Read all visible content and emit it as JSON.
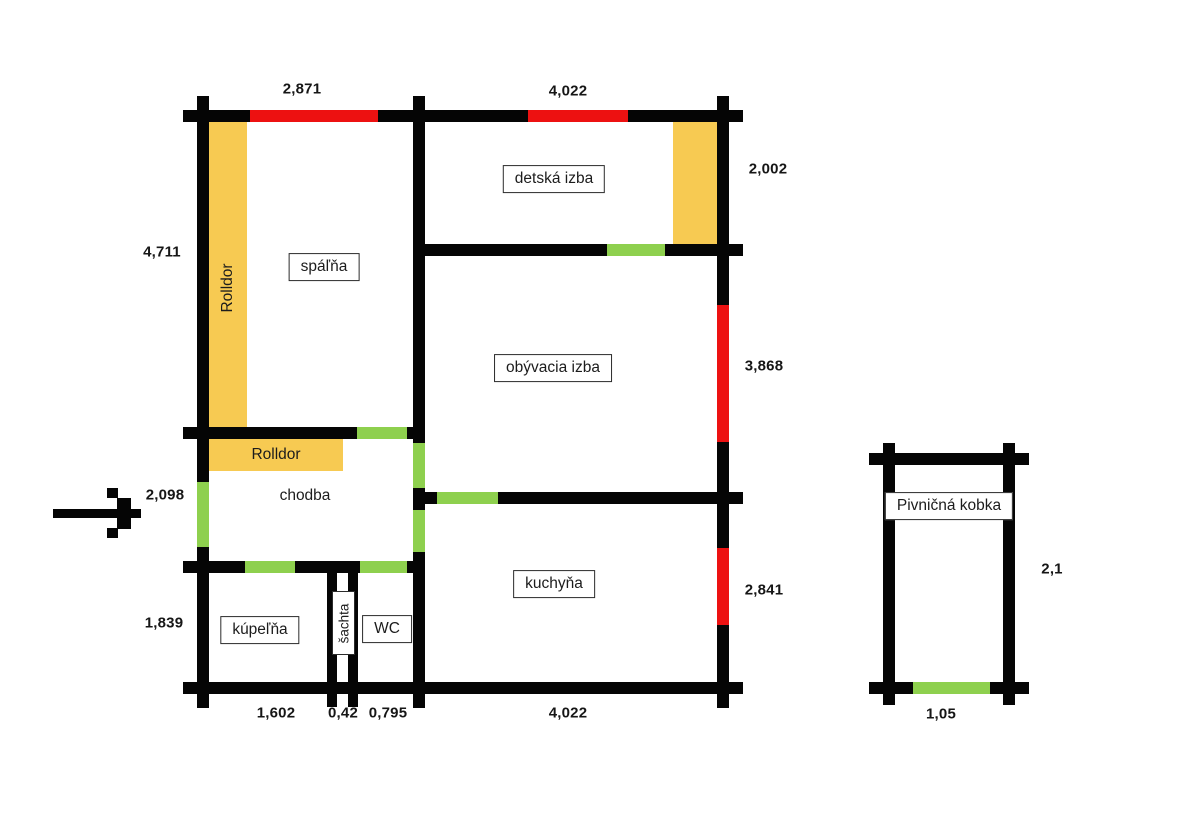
{
  "colors": {
    "wall": "#050505",
    "window_marker": "#ED1111",
    "door_marker": "#8ED04E",
    "wardrobe": "#F7CA52",
    "background": "#FFFFFF"
  },
  "rooms": {
    "spalna": "spáľňa",
    "detska_izba": "detská izba",
    "obyvacia_izba": "obývacia izba",
    "chodba": "chodba",
    "kuchyna": "kuchyňa",
    "kupelna": "kúpeľňa",
    "wc": "WC",
    "sachta": "šachta",
    "pivnicna_kobka": "Pivničná kobka"
  },
  "wardrobes": {
    "spalna_rolldor": "Rolldor",
    "chodba_rolldor": "Rolldor"
  },
  "dimensions": {
    "spalna_width": "2,871",
    "detska_izba_width": "4,022",
    "detska_izba_height": "2,002",
    "spalna_height": "4,711",
    "obyvacia_izba_height": "3,868",
    "chodba_height": "2,098",
    "kuchyna_height": "2,841",
    "kupelna_height": "1,839",
    "kupelna_width": "1,602",
    "sachta_width": "0,42",
    "wc_width": "0,795",
    "kuchyna_width": "4,022",
    "pivnica_width": "1,05",
    "pivnica_height": "2,1"
  }
}
